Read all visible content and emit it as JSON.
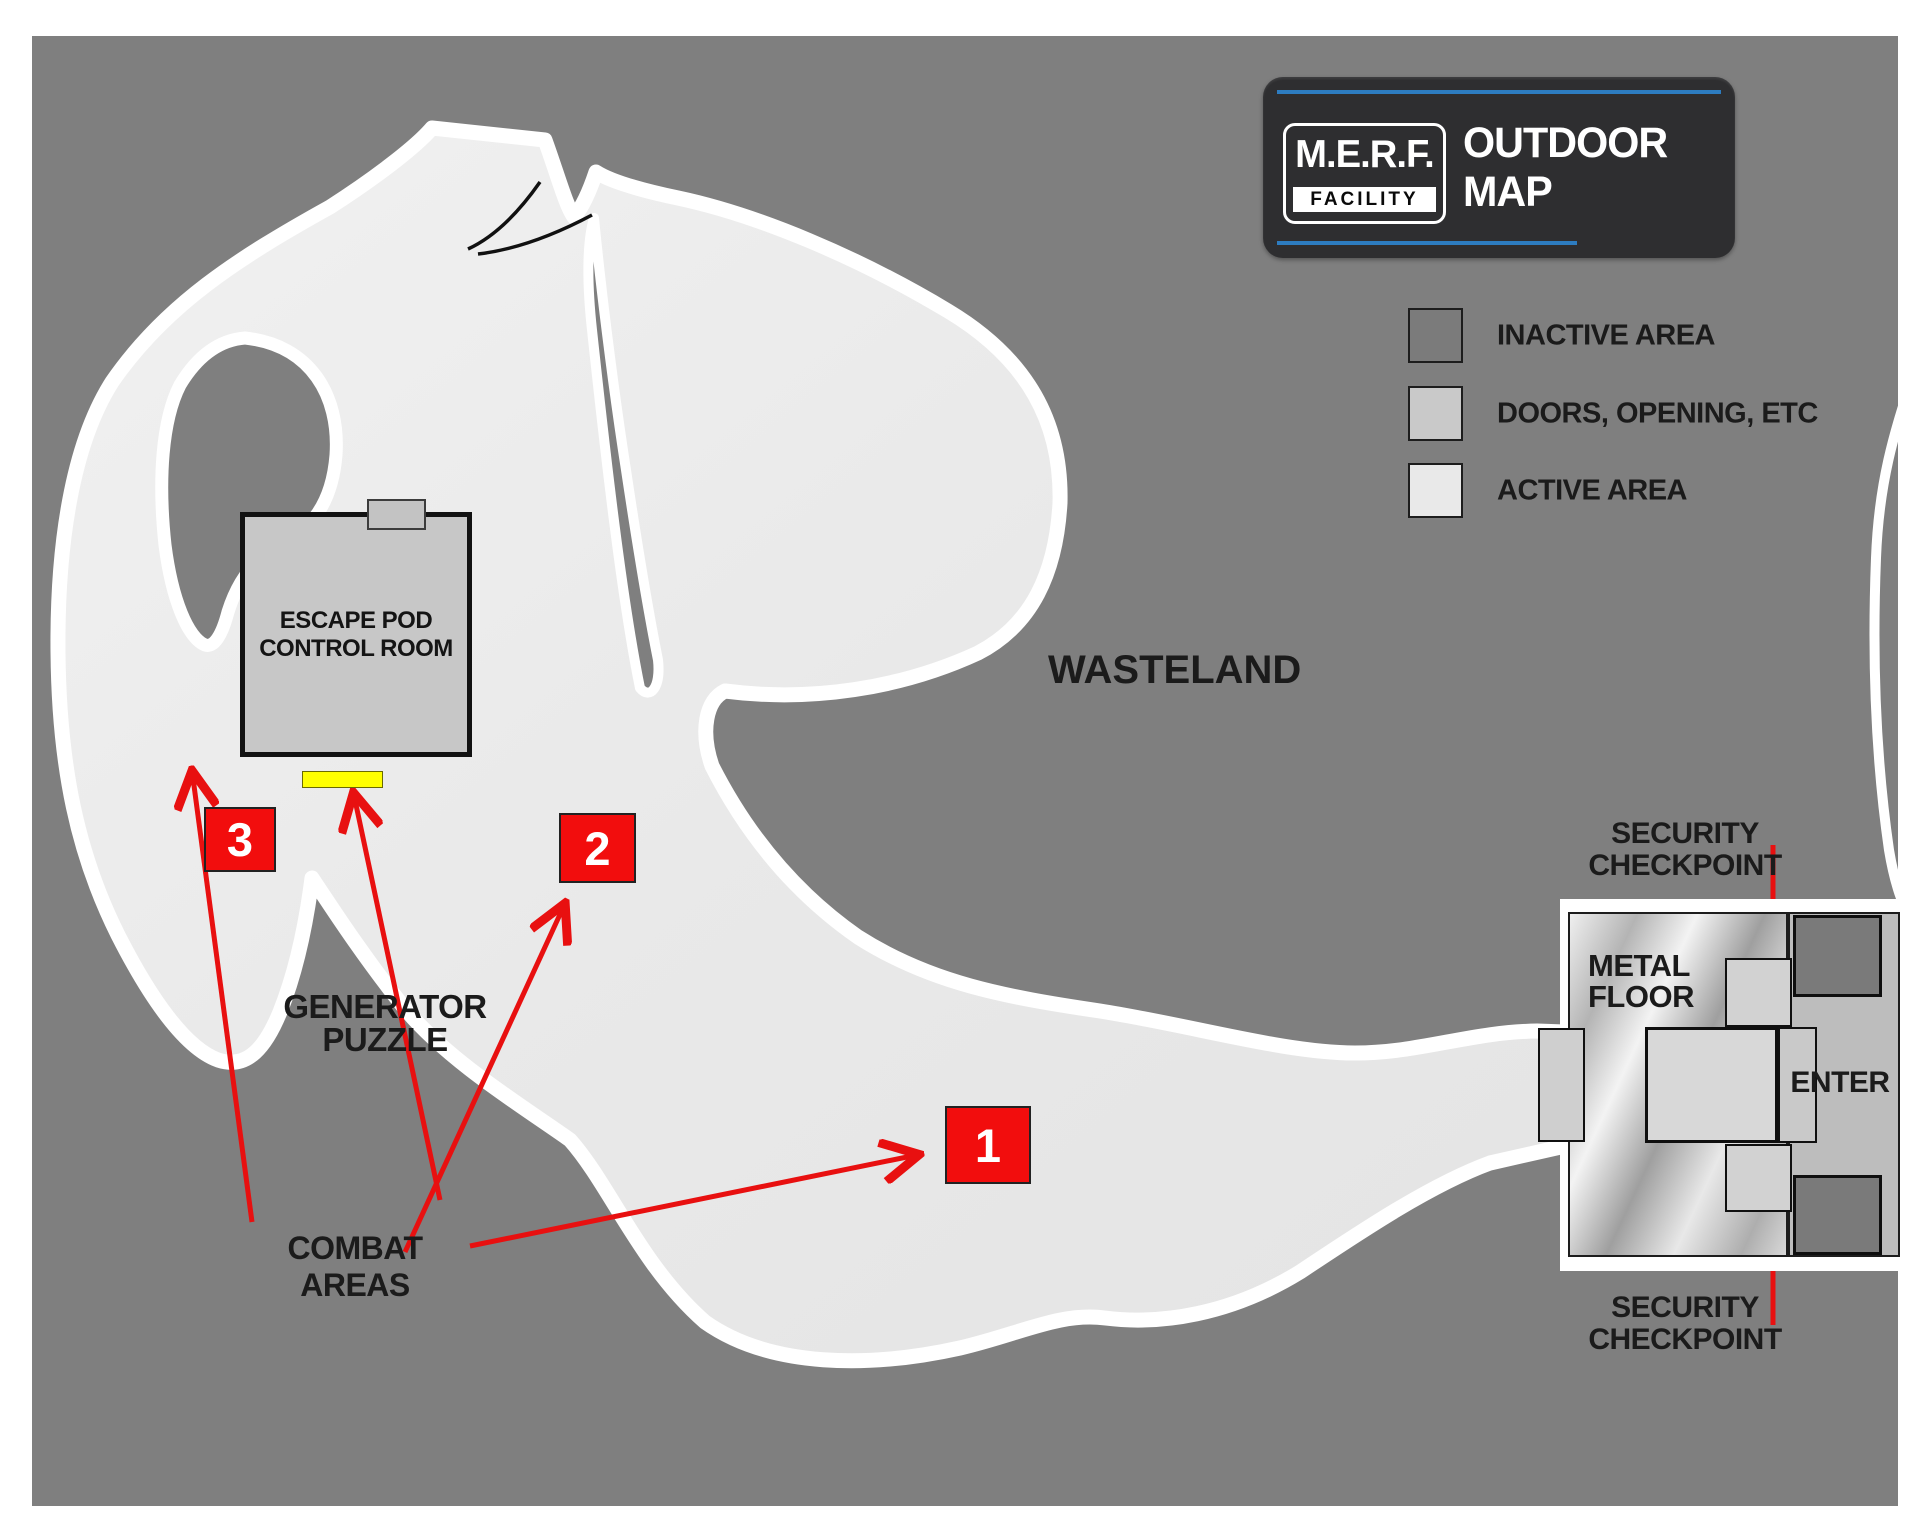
{
  "header": {
    "logo_line1": "M.E.R.F.",
    "logo_line2": "FACILITY",
    "title": "OUTDOOR MAP"
  },
  "legend": {
    "items": [
      {
        "label": "INACTIVE AREA",
        "swatch": "#7b7b7b"
      },
      {
        "label": "DOORS, OPENING, ETC",
        "swatch": "#c9c9c9"
      },
      {
        "label": "ACTIVE AREA",
        "swatch": "#e9e9e9"
      }
    ]
  },
  "map": {
    "wasteland_label": "WASTELAND",
    "room_label": "ESCAPE POD\nCONTROL ROOM",
    "generator_label": "GENERATOR\nPUZZLE",
    "combat_label": "COMBAT AREAS",
    "security_checkpoint_top": "SECURITY\nCHECKPOINT",
    "security_checkpoint_bottom": "SECURITY\nCHECKPOINT",
    "metal_floor_label": "METAL\nFLOOR",
    "enter_label": "ENTER",
    "markers": [
      {
        "label": "1"
      },
      {
        "label": "2"
      },
      {
        "label": "3"
      }
    ],
    "colors": {
      "background_gray": "#7f7f7f",
      "active_area": "#e9e9e9",
      "doors": "#c9c9c9",
      "inactive_area": "#7b7b7b",
      "combat_red": "#f20d0d",
      "generator_yellow": "#ffff00",
      "arrow_red": "#e81010",
      "header_blue": "#2d7cc0",
      "header_bg": "#2e2e30"
    }
  }
}
